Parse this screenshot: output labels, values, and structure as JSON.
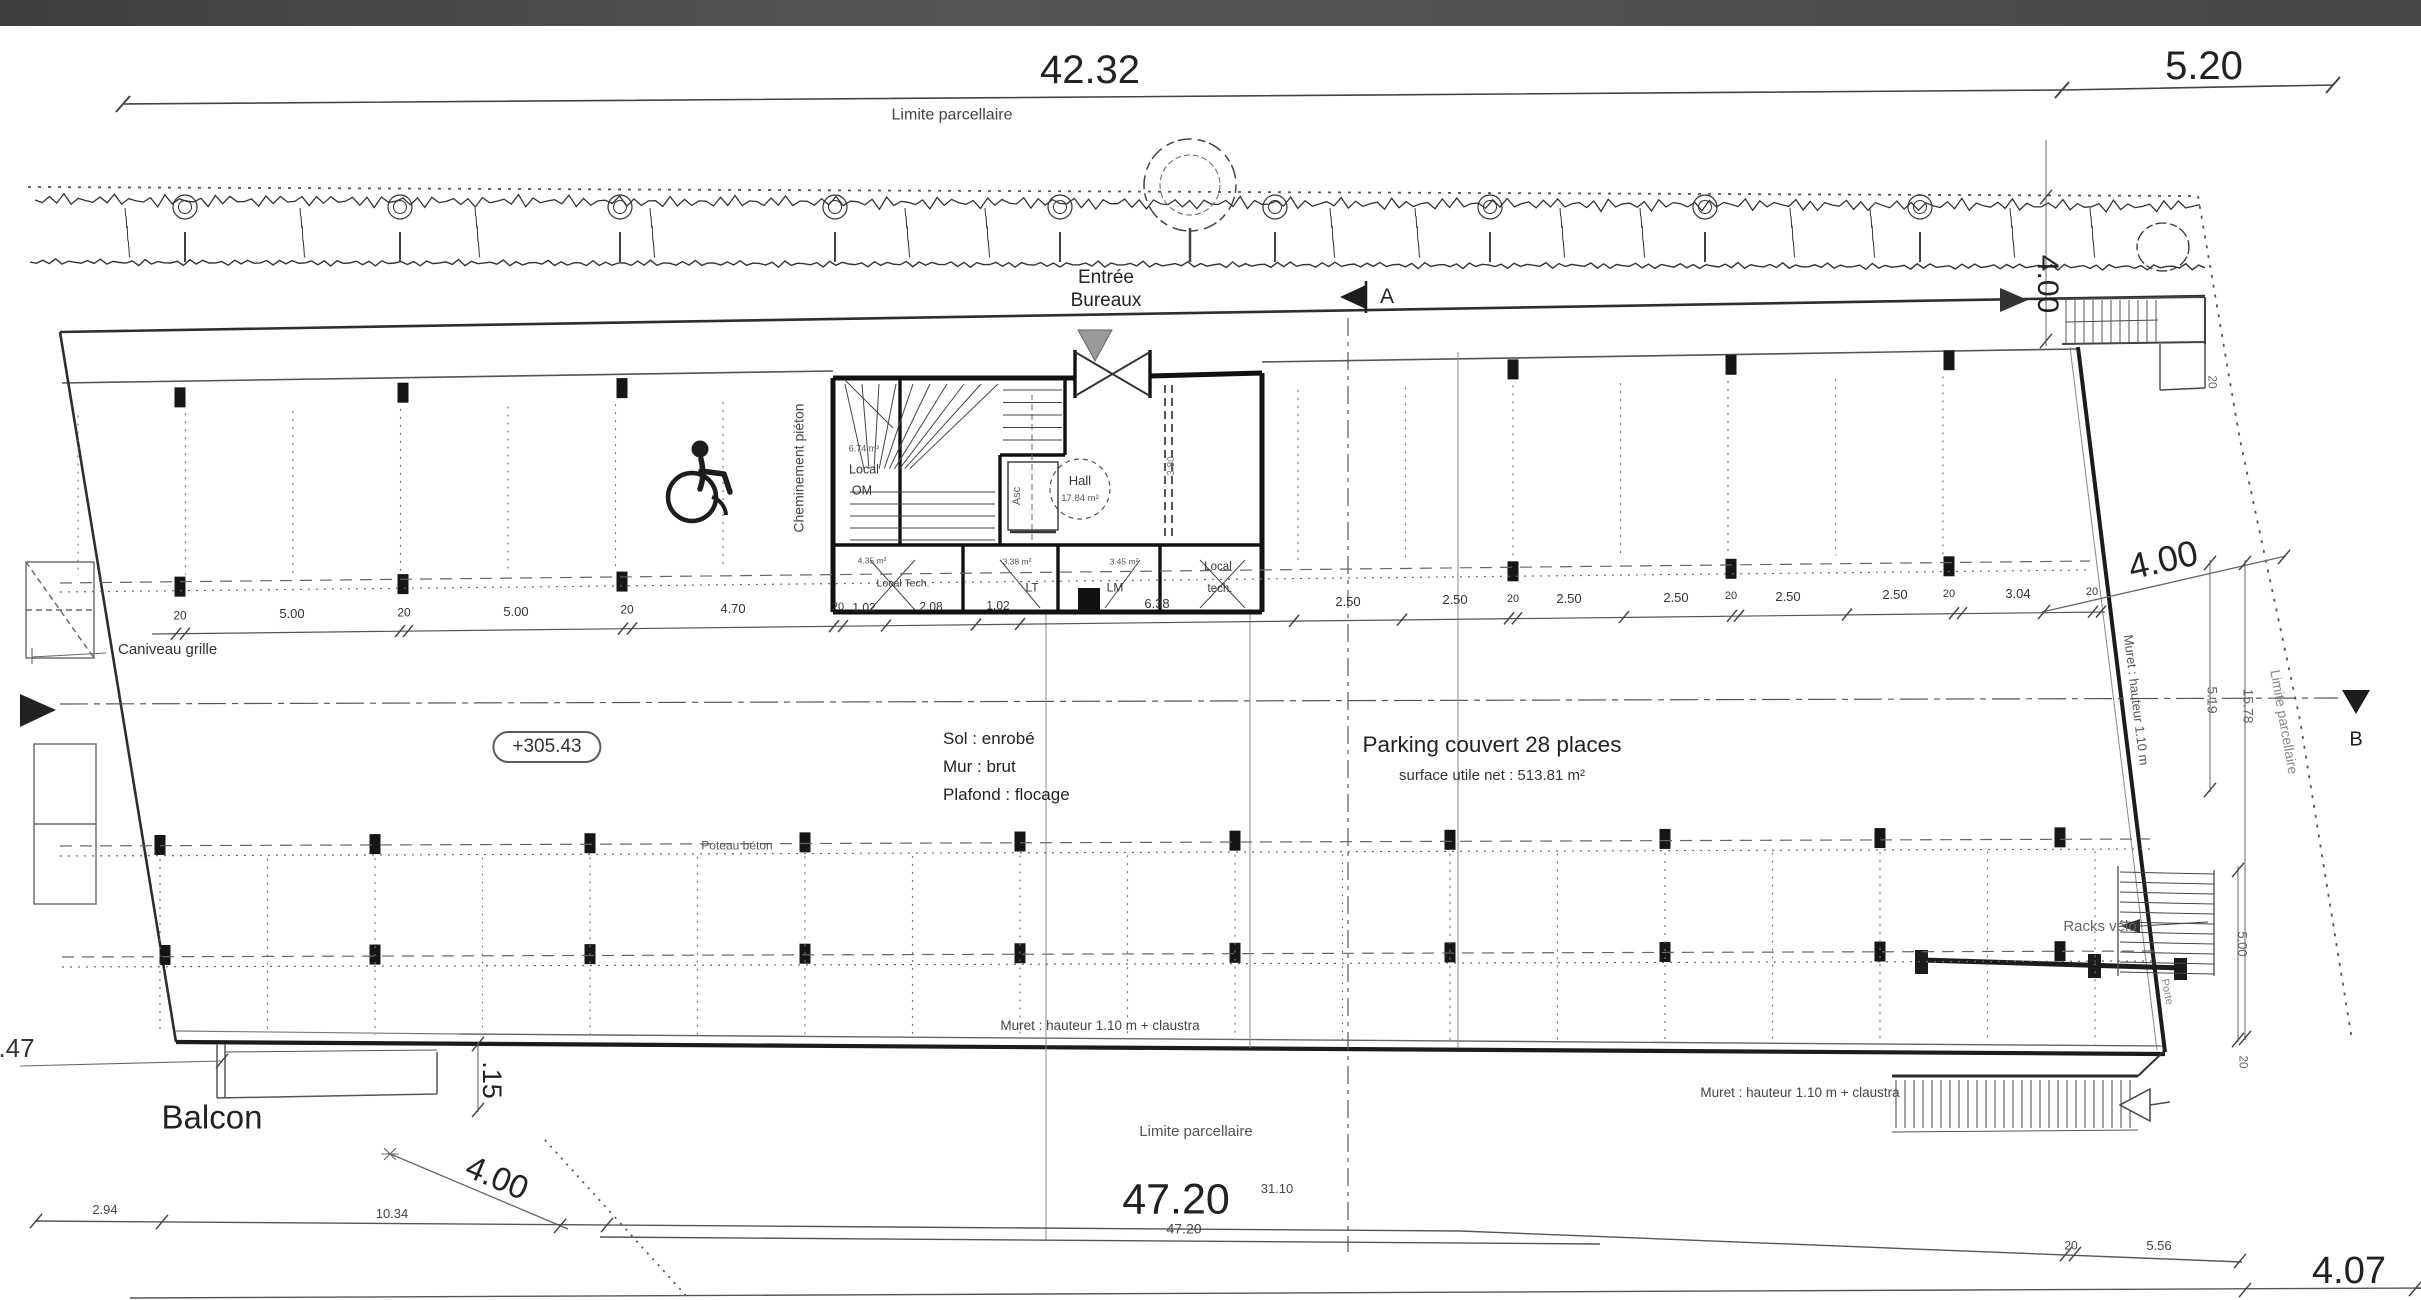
{
  "dims": {
    "top_main": "42.32",
    "top_right": "5.20",
    "top_right_vertical": "4.00",
    "mid_string": [
      "20",
      "5.00",
      "20",
      "5.00",
      "20",
      "4.70",
      "20",
      "1.02",
      "2.08",
      "1.02",
      "6.38",
      "2.50",
      "2.50",
      "20",
      "2.50",
      "2.50",
      "20",
      "2.50",
      "2.50",
      "20",
      "3.04",
      "20"
    ],
    "hall_partition": "3.80",
    "right_diag": "4.00",
    "right_519": "5.19",
    "right_1578": "15.78",
    "right_20_top": "20",
    "right_500": "5.00",
    "right_20_bottom": "20",
    "bottom": {
      "b294": "2.94",
      "b1034": "10.34",
      "b547": "5.47",
      "b015": ".15",
      "b400": "4.00",
      "b4720_big": "47.20",
      "b4720_small": "47.20",
      "b3110": "31.10",
      "b20": "20",
      "b556": "5.56",
      "b407": "4.07"
    }
  },
  "labels": {
    "limite_top": "Limite parcellaire",
    "limite_bottom": "Limite parcellaire",
    "limite_right": "Limite parcellaire",
    "entree_l1": "Entrée",
    "entree_l2": "Bureaux",
    "cheminement": "Cheminement piéton",
    "caniveau": "Caniveau grille",
    "sol": "Sol : enrobé",
    "mur": "Mur : brut",
    "plafond": "Plafond : flocage",
    "parking_title": "Parking couvert 28 places",
    "parking_sub": "surface utile net : 513.81 m²",
    "poteau": "Poteau béton",
    "racks": "Racks vélo",
    "muret1": "Muret : hauteur 1.10 m + claustra",
    "muret2": "Muret : hauteur 1.10 m + claustra",
    "muret_right": "Muret : hauteur 1.10 m",
    "balcon": "Balcon",
    "porte": "Porte"
  },
  "level": "+305.43",
  "markers": {
    "section_a": "A",
    "section_b": "B"
  },
  "rooms": {
    "hall": {
      "name": "Hall",
      "area": "17.84 m²"
    },
    "local_om": {
      "area": "6.74 m²",
      "l1": "Local",
      "l2": "OM"
    },
    "asc": "Asc",
    "t1": {
      "area": "4.35 m²",
      "name": "Local Tech."
    },
    "t2": {
      "area": "3.38 m²",
      "name": "LT"
    },
    "t3": {
      "area": "3.45 m²",
      "name": "LM"
    },
    "t4": {
      "l1": "Local",
      "l2": "tech."
    }
  }
}
